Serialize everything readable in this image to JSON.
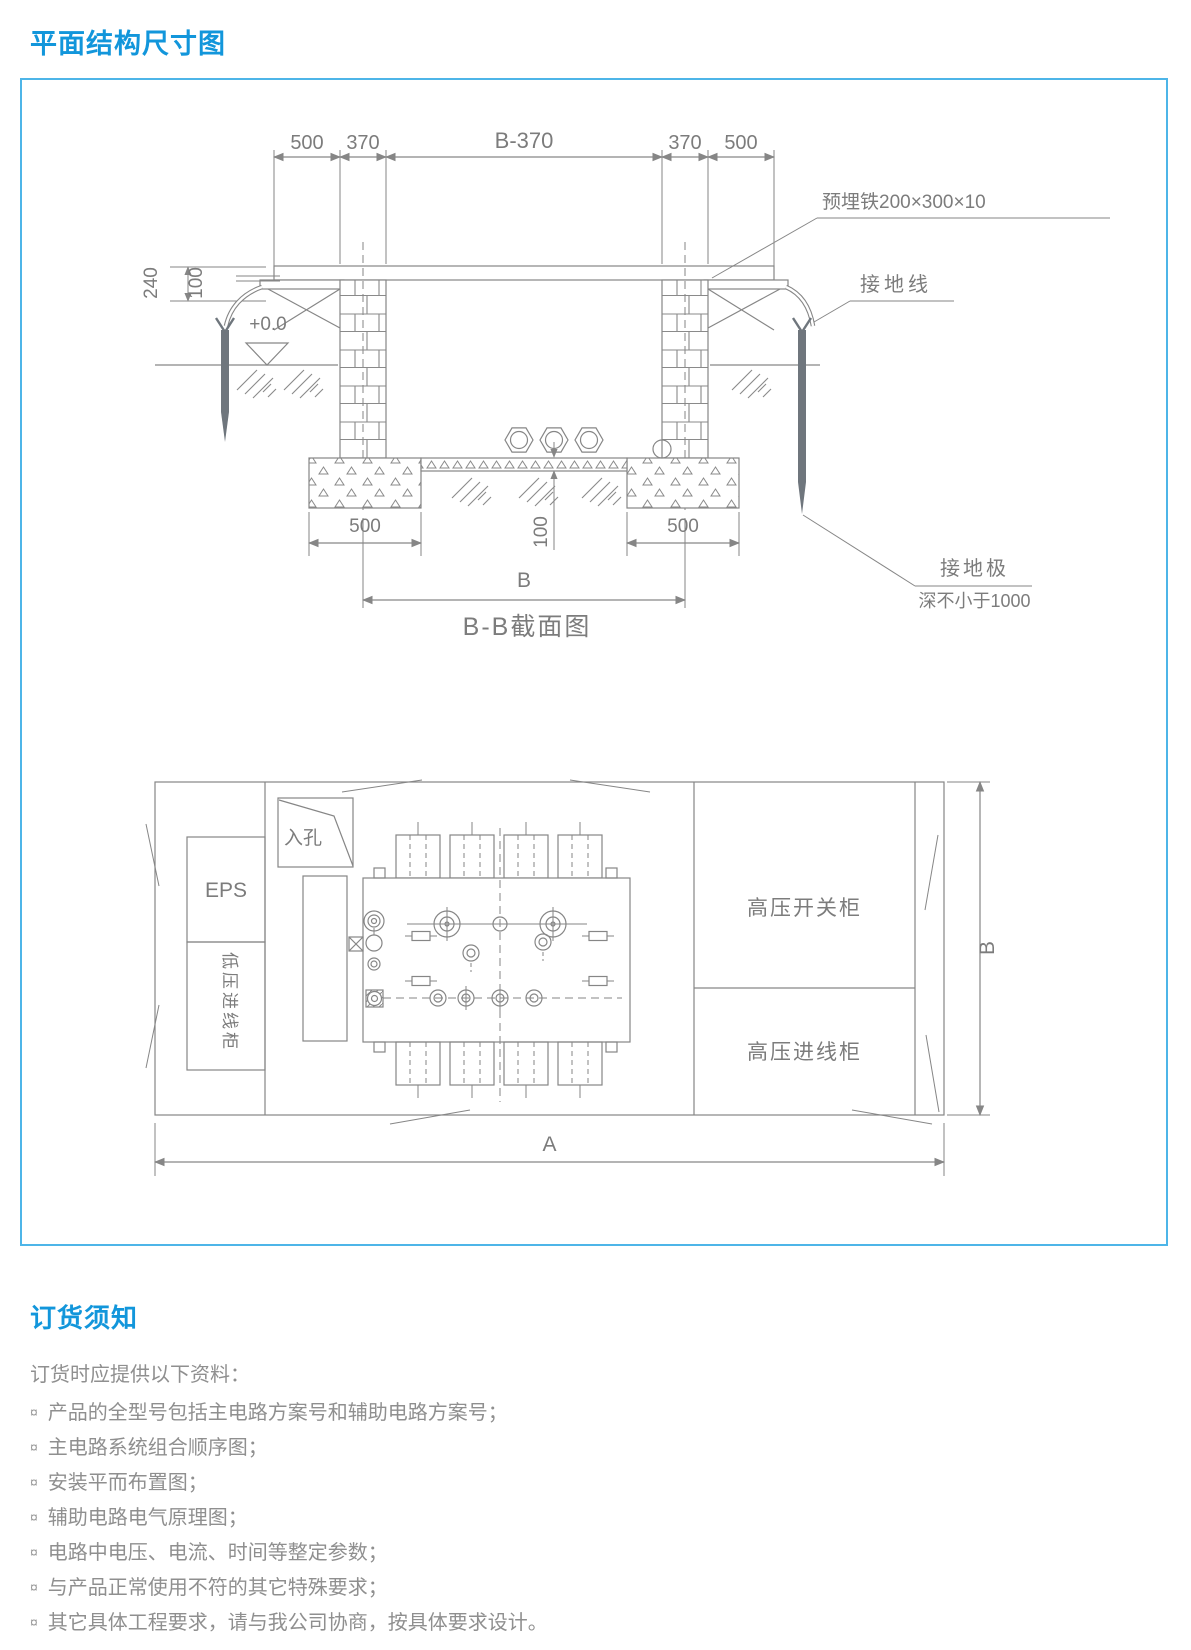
{
  "header": {
    "title": "平面结构尺寸图"
  },
  "drawing": {
    "section": {
      "dims_top": [
        "500",
        "370",
        "B-370",
        "370",
        "500"
      ],
      "dim_240": "240",
      "dim_100_left": "100",
      "level": "+0.0",
      "ann_embedded_plate": "预埋铁200×300×10",
      "ann_ground_wire": "接地线",
      "dim_100_mid": "100",
      "dim_found_left": "500",
      "dim_found_right": "500",
      "dim_span": "B",
      "ann_ground_rod": "接地极",
      "ann_ground_rod_depth": "深不小于1000",
      "caption": "B-B截面图"
    },
    "plan": {
      "manhole": "入孔",
      "eps": "EPS",
      "lv_cabinet": "低压进线柜",
      "hv_switch": "高压开关柜",
      "hv_incoming": "高压进线柜",
      "dim_width": "B",
      "dim_length": "A"
    }
  },
  "ordering": {
    "title": "订货须知",
    "intro": "订货时应提供以下资料：",
    "bullet": "¤",
    "items": [
      "产品的全型号包括主电路方案号和辅助电路方案号；",
      "主电路系统组合顺序图；",
      "安装平而布置图；",
      "辅助电路电气原理图；",
      "电路中电压、电流、时间等整定参数；",
      "与产品正常使用不符的其它特殊要求；",
      "其它具体工程要求，请与我公司协商，按具体要求设计。"
    ]
  }
}
